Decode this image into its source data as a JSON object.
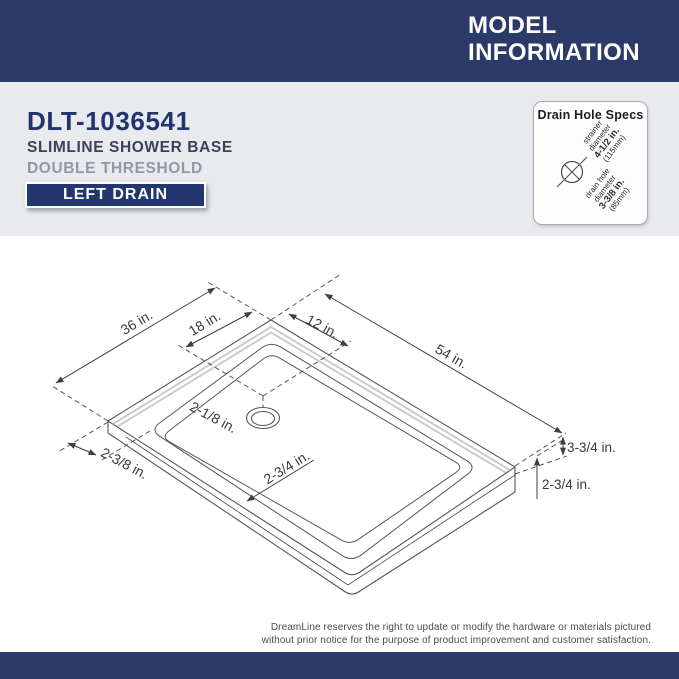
{
  "header": {
    "title_line1": "MODEL",
    "title_line2": "INFORMATION"
  },
  "product": {
    "model": "DLT-1036541",
    "name": "SLIMLINE SHOWER BASE",
    "threshold": "DOUBLE THRESHOLD",
    "drain_badge": "LEFT DRAIN"
  },
  "drain_specs": {
    "title": "Drain Hole Specs",
    "strainer_line1": "strainer",
    "strainer_line2": "diameter",
    "strainer_value": "4-1/2 in.",
    "strainer_metric": "(115mm)",
    "drain_line1": "drain hole",
    "drain_line2": "diameter",
    "drain_value": "3-3/8 in.",
    "drain_metric": "(85mm)"
  },
  "diagram": {
    "dim_width": "36 in.",
    "dim_drain_from_left": "18 in.",
    "dim_drain_from_top": "12 in.",
    "dim_length": "54 in.",
    "dim_drain_lip": "2-1/8 in.",
    "dim_threshold_side": "2-3/8 in.",
    "dim_threshold_front": "2-3/4 in.",
    "dim_height_rim": "3-3/4 in.",
    "dim_height_threshold": "2-3/4 in."
  },
  "footer": {
    "disclaimer_line1": "DreamLine reserves the right to update or modify the hardware or materials pictured",
    "disclaimer_line2": "without prior notice for the purpose of product improvement and customer satisfaction."
  },
  "colors": {
    "navy": "#2b3a68",
    "band_gray": "#e9eaee",
    "drawing_line": "#55565a",
    "dimension_text": "#39393c",
    "flange_gray": "#c6c7cb"
  }
}
